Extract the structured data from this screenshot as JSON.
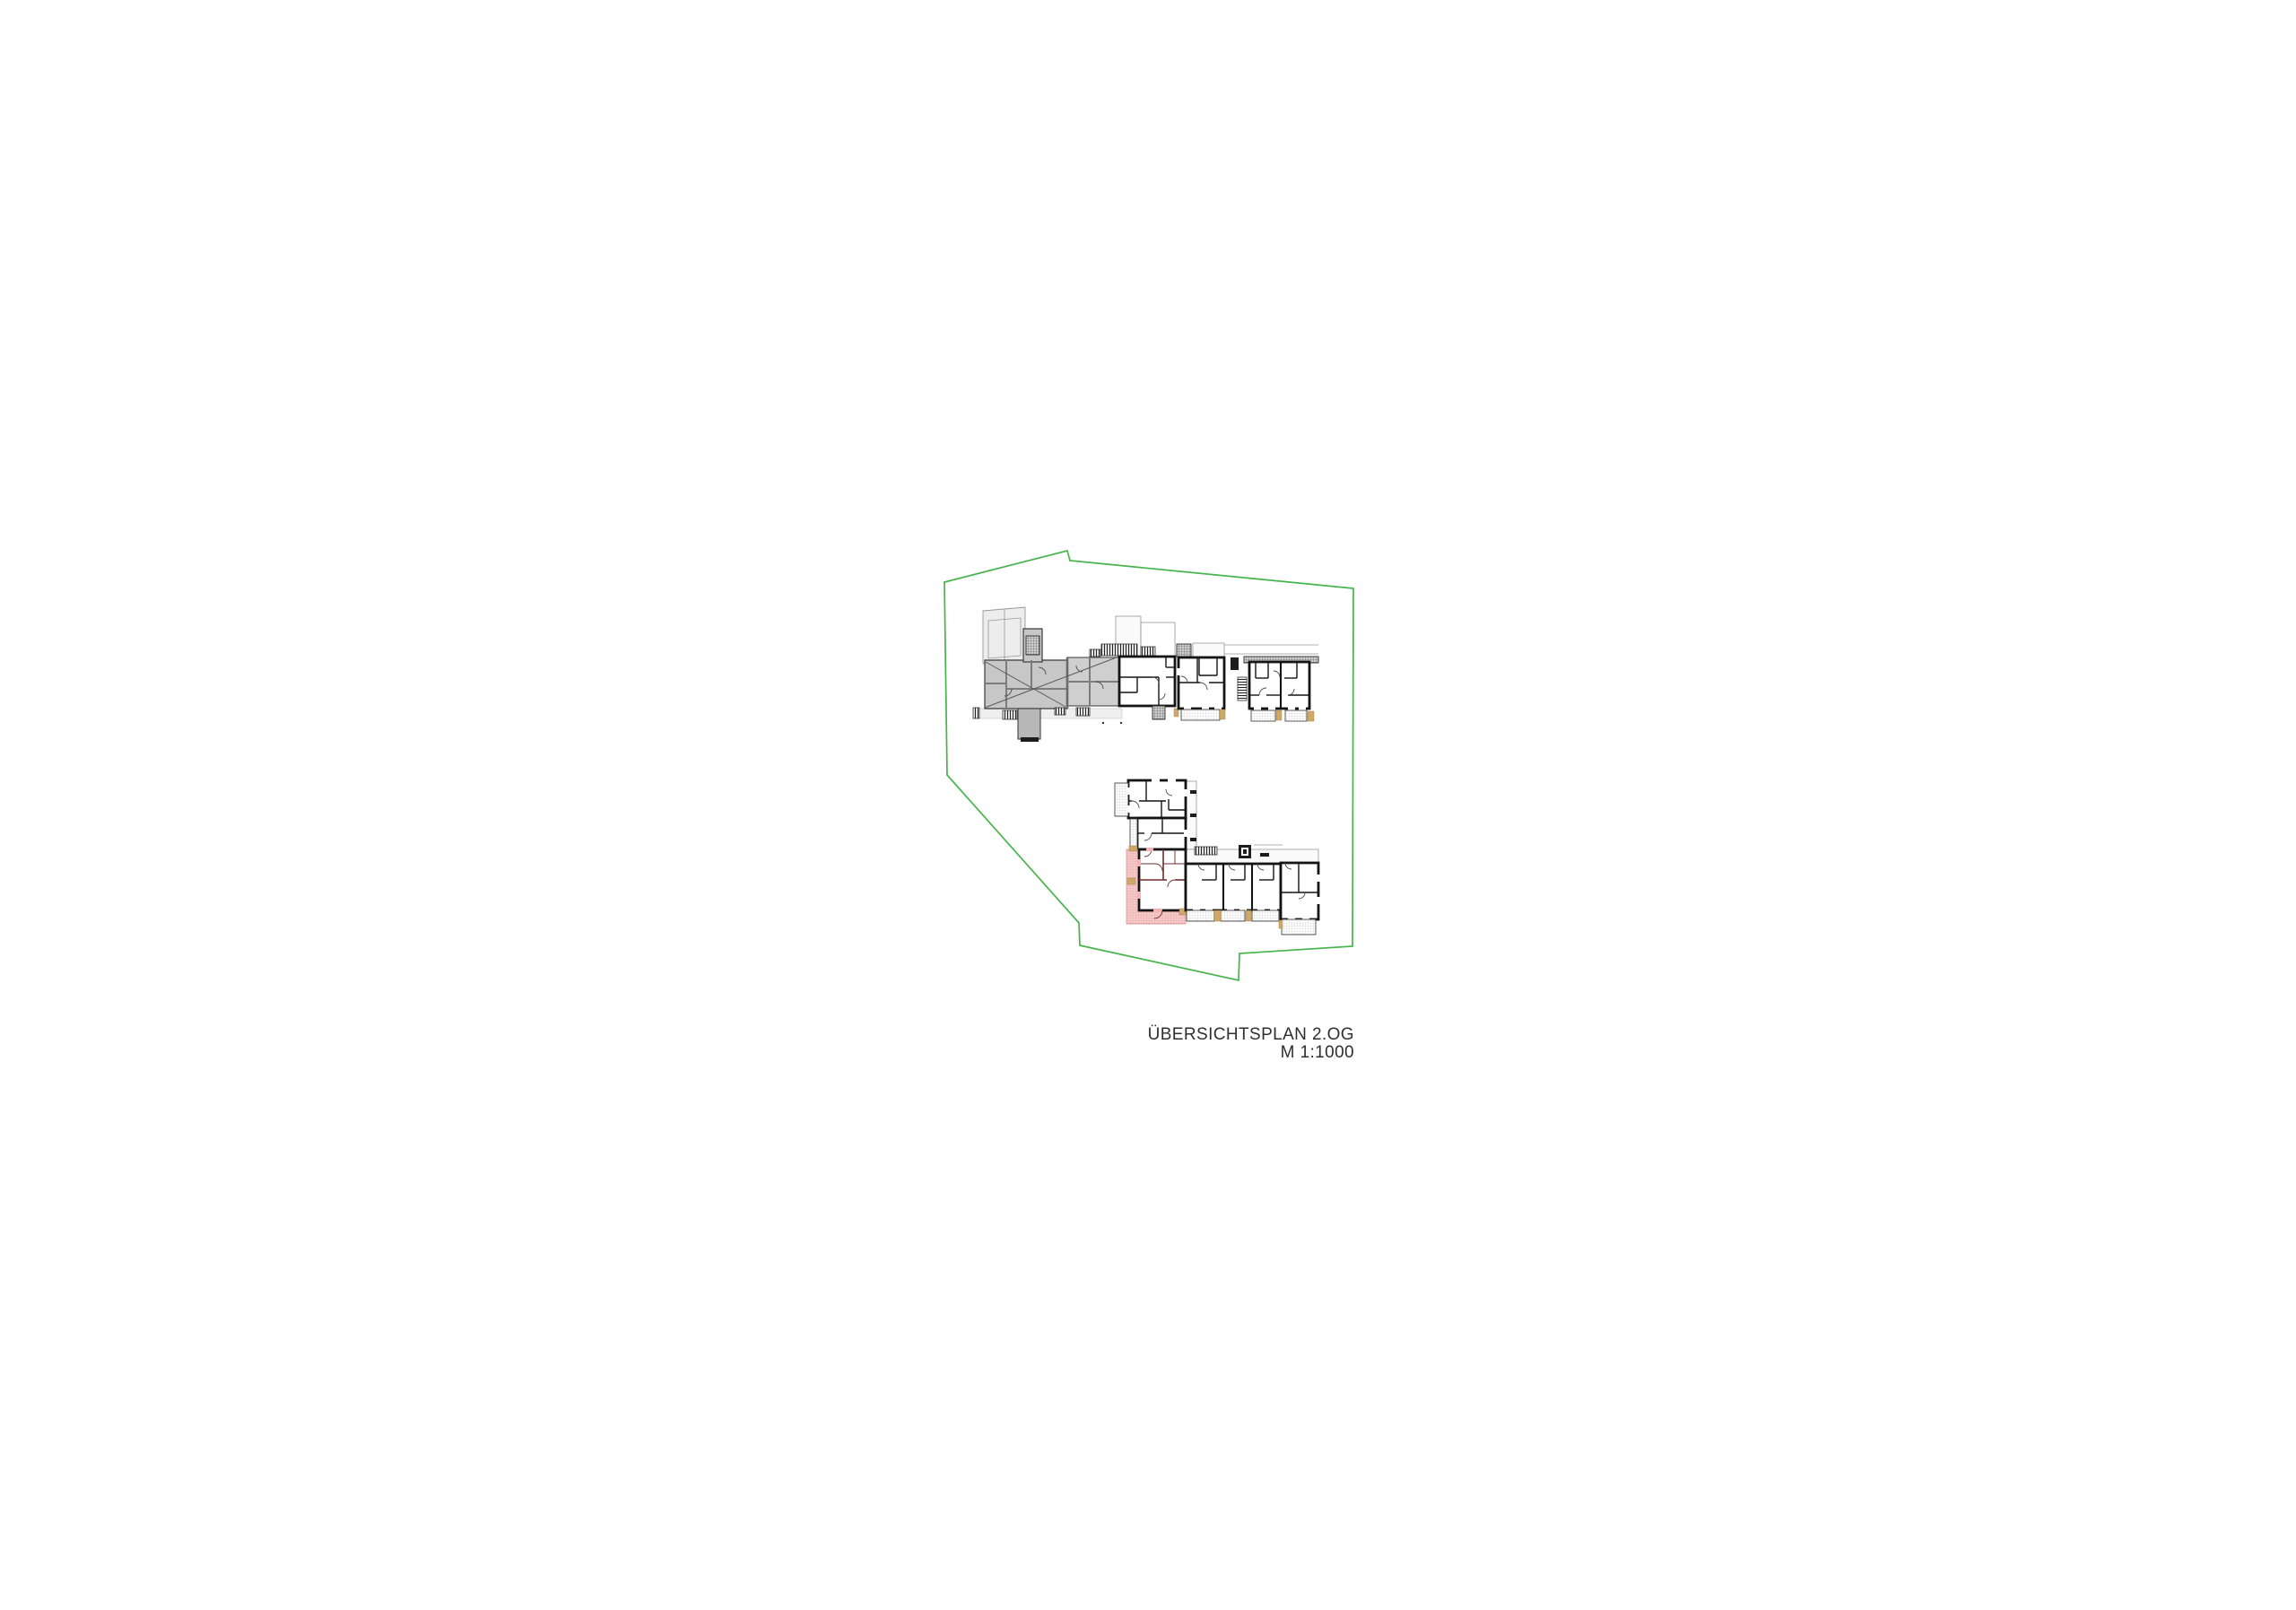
{
  "page": {
    "background": "#ffffff"
  },
  "caption": {
    "line1": "ÜBERSICHTSPLAN 2.OG",
    "line2": "M 1:1000"
  },
  "colors": {
    "site_boundary": "#45b44a",
    "existing_fill": "#c7c7c7",
    "existing_wall": "#7d7d7d",
    "new_wall": "#141414",
    "roof_line": "#979797",
    "balcony_line": "#c6c6c6",
    "unit_fill": "#f4b3b3",
    "unit_wall": "#6e2c2c",
    "terrace_fill": "#f6caca",
    "terrace_line": "#e29b9b",
    "door_marker": "#cfa967",
    "caption_text": "#2f2f2f"
  }
}
